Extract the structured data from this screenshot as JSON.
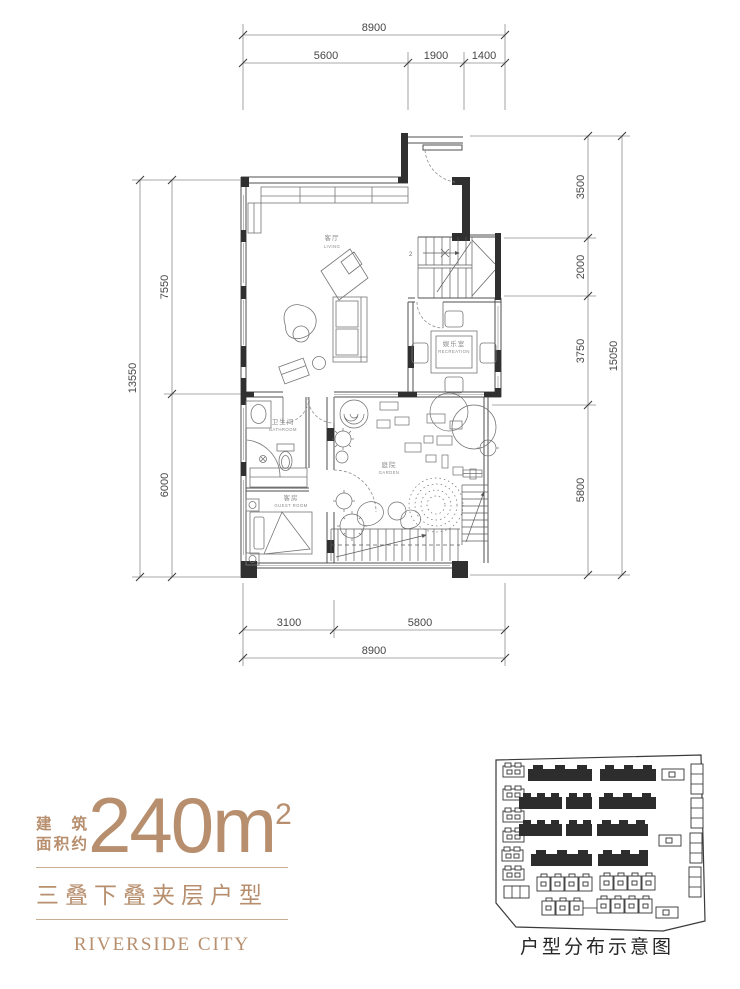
{
  "colors": {
    "accent": "#b78f6e",
    "wall": "#303030",
    "line": "#555555"
  },
  "title_block": {
    "area_label_line1": "建筑",
    "area_label_line2": "面积约",
    "area_value": "240",
    "area_unit": "m",
    "area_exponent": "2",
    "type_name": "三叠下叠夹层户型",
    "brand": "RIVERSIDE CITY"
  },
  "floor_plan": {
    "rooms": {
      "living": {
        "cn": "客厅",
        "en": "LIVING"
      },
      "recreation": {
        "cn": "娱乐室",
        "en": "RECREATION"
      },
      "bathroom": {
        "cn": "卫生间",
        "en": "BATHROOM"
      },
      "guest": {
        "cn": "客房",
        "en": "GUEST ROOM"
      },
      "garden": {
        "cn": "庭院",
        "en": "GARDEN"
      }
    },
    "stair_mark": "2",
    "dimensions": {
      "top": {
        "total": "8900",
        "segments": [
          "5600",
          "1900",
          "1400"
        ]
      },
      "bottom": {
        "total": "8900",
        "segments": [
          "3100",
          "5800"
        ]
      },
      "left": {
        "total": "13550",
        "segments": [
          "7550",
          "6000"
        ]
      },
      "right": {
        "total": "15050",
        "segments": [
          "3500",
          "2000",
          "3750",
          "5800"
        ]
      }
    }
  },
  "site_plan": {
    "caption": "户型分布示意图"
  }
}
